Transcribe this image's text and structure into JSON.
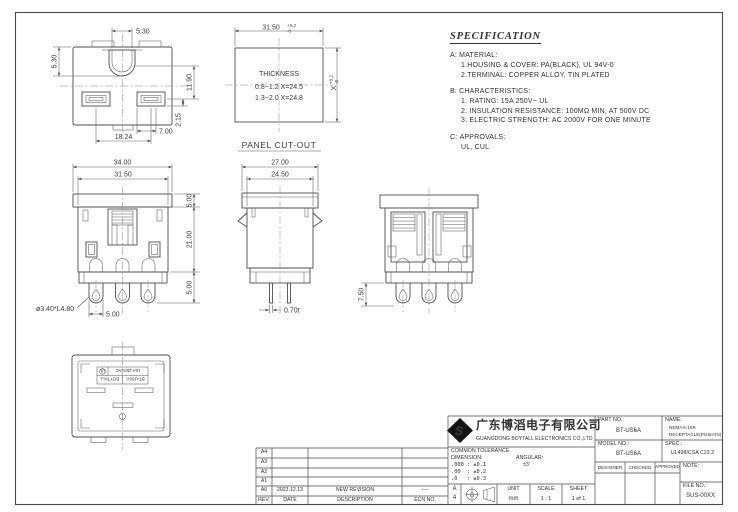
{
  "page": {
    "bg": "#ffffff",
    "frame_color": "#4a4a4a"
  },
  "spec": {
    "title": "SPECIFICATION",
    "sections": [
      {
        "label": "A:",
        "heading": "MATERIAL:",
        "items": [
          "1.HOUSING & COVER: PA(BLACK), UL 94V-0",
          "2.TERMINAL: COPPER ALLOY, TIN PLATED"
        ]
      },
      {
        "label": "B:",
        "heading": "CHARACTERISTICS:",
        "items": [
          "1. RATING: 15A 250V~ UL",
          "2. INSULATION RESISTANCE: 100MΩ MIN, AT 500V DC",
          "3. ELECTRIC STRENGTH: AC 2000V FOR ONE MINUTE"
        ]
      },
      {
        "label": "C:",
        "heading": "APPROVALS:",
        "items": [
          "UL, CUL"
        ]
      }
    ]
  },
  "views": {
    "face": {
      "dim_slot_width": "5.30",
      "dim_top_offset": "5.30",
      "dim_1190": "11.90",
      "dim_215": "2.15",
      "dim_700": "7.00",
      "dim_1824": "18.24"
    },
    "panel_cutout": {
      "dim_width": "31.50",
      "tol_plus": "+0.2",
      "tol_minus": "-0",
      "dim_x": "X",
      "x_tol_plus": "+0.2",
      "x_tol_minus": "-0",
      "thickness_title": "THICKNESS",
      "thickness_row1": "0.8~1.2 X=24.5",
      "thickness_row2": "1.3~2.0 X=24.8",
      "caption": "PANEL CUT-OUT"
    },
    "front": {
      "dim_3400": "34.00",
      "dim_3150": "31.50",
      "dim_500_top": "5.00",
      "dim_2100": "21.00",
      "dim_500_bottom": "5.00",
      "dim_pin": "ø3.40*L4.80",
      "dim_500_pitch": "5.00"
    },
    "side": {
      "dim_2700": "27.00",
      "dim_2450": "24.50",
      "dim_070": "0.70t"
    },
    "back": {
      "dim_750": "7.50"
    },
    "bottom": {
      "ul_mark": "UL",
      "rating": "15A 250VAC",
      "brand": "BOYTALL",
      "model": "BT-US6A"
    }
  },
  "title_block": {
    "company_cn": "广东博滔电子有限公司",
    "company_en": "GUANGDONG BOYTALL ELECTRONICS CO.,LTD",
    "part_no_label": "PART NO.:",
    "part_no": "BT-US6A",
    "name_label": "NAME:",
    "name_line1": "NEMA 6-15R",
    "name_line2": "RECEPTACLE(PUSH-IN)",
    "model_no_label": "MODEL NO.:",
    "model_no": "BT-US6A",
    "spec_label": "SPEC.:",
    "spec_value": "UL498/CSA C22.2",
    "designer_label": "DESIGNER",
    "checked_label": "CHECKED",
    "approved_label": "APPROVED",
    "note_label": "NOTE:",
    "file_no_label": "FILE NO.:",
    "file_no": "SUS-00XX",
    "tolerance_title": "COMMON TOLERANCE",
    "dimension_label": "DIMENSION:",
    "angular_label": "ANGULAR:",
    "tol_row1": ".000 : ±0.1",
    "tol_row2": ".00  : ±0.2",
    "tol_row3": ".0   : ±0.3",
    "angular_value": "±3'",
    "sheet_size_letter": "A",
    "sheet_size_number": "4",
    "unit_label": "UNIT",
    "unit_value": "mm",
    "scale_label": "SCALE",
    "scale_value": "1 : 1",
    "sheet_label": "SHEET",
    "sheet_value": "1 of 1"
  },
  "revision_table": {
    "header": {
      "rev": "REV.",
      "date": "DATE",
      "description": "DESCRIPTION",
      "ecn": "ECN NO."
    },
    "rows": [
      {
        "rev": "A4",
        "date": "",
        "description": "",
        "ecn": ""
      },
      {
        "rev": "A3",
        "date": "",
        "description": "",
        "ecn": ""
      },
      {
        "rev": "A2",
        "date": "",
        "description": "",
        "ecn": ""
      },
      {
        "rev": "A1",
        "date": "",
        "description": "",
        "ecn": ""
      },
      {
        "rev": "A0",
        "date": "2023.12.13",
        "description": "NEW REVISION",
        "ecn": "----"
      }
    ]
  }
}
